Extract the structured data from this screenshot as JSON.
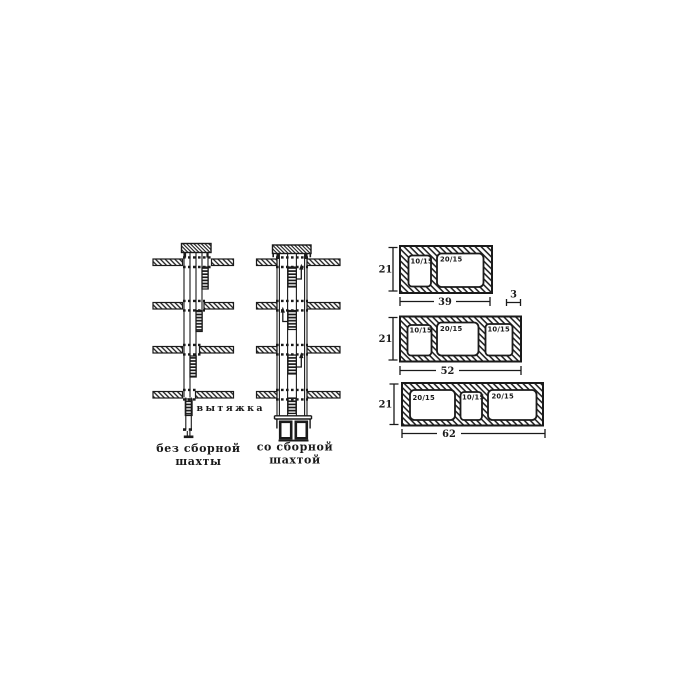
{
  "palette": {
    "ink": "#1a1a1a",
    "paper": "#ffffff"
  },
  "left_diagram": {
    "exhaust_label": "вытяжка",
    "caption": [
      "без сборной",
      "шахты"
    ]
  },
  "right_diagram": {
    "caption": [
      "со сборной",
      "шахтой"
    ]
  },
  "blocks": [
    {
      "height": "21",
      "width": "39",
      "wall_thickness": "3",
      "openings": [
        "10/15",
        "20/15"
      ]
    },
    {
      "height": "21",
      "width": "52",
      "openings": [
        "10/15",
        "20/15",
        "10/15"
      ]
    },
    {
      "height": "21",
      "width": "62",
      "openings": [
        "20/15",
        "10/15",
        "20/15"
      ]
    }
  ]
}
